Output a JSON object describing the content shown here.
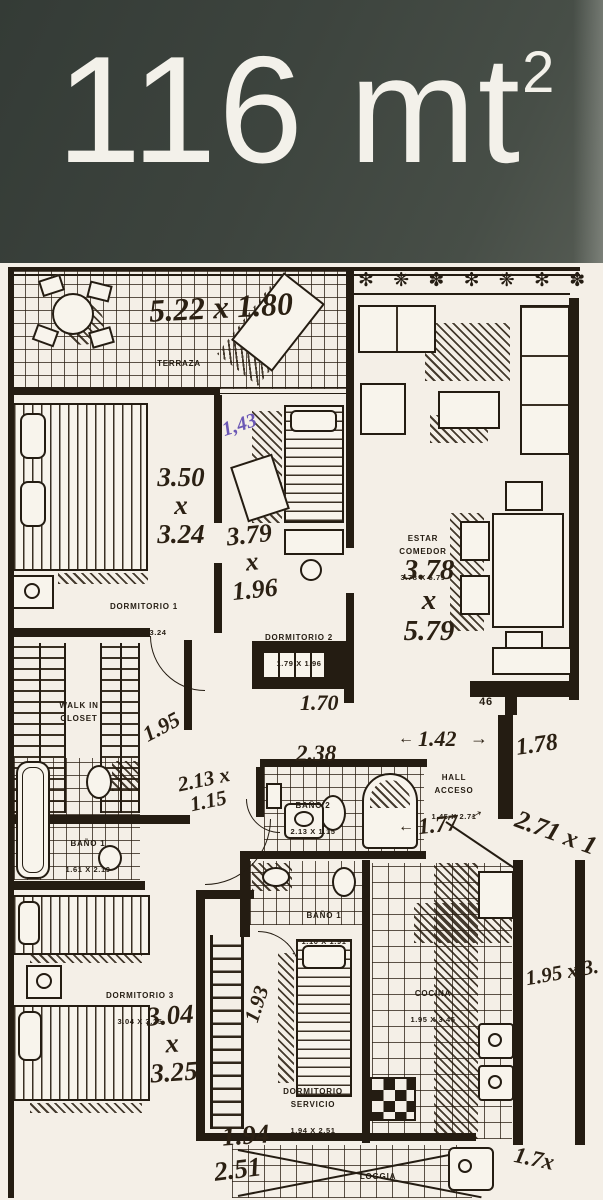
{
  "header": {
    "area_value": "116 mt",
    "area_exponent": "2"
  },
  "colors": {
    "header_bg": "#3d443e",
    "header_fg": "#f3f1ea",
    "paper": "#f4efe7",
    "ink": "#241c12",
    "purple_ink": "#6b57b5"
  },
  "rooms": {
    "terraza": {
      "name": "TERRAZA",
      "dims": "5.22 X 1.80"
    },
    "estar": {
      "name": "ESTAR\nCOMEDOR",
      "dims": "3.78 X 5.79"
    },
    "dormitorio1": {
      "name": "DORMITORIO 1",
      "dims": "3.50 X 3.24"
    },
    "dormitorio2": {
      "name": "DORMITORIO 2",
      "dims": "1.79 X 1.96"
    },
    "walkin": {
      "name": "WALK IN\nCLOSET"
    },
    "bano1_suite": {
      "name": "BAÑO 1",
      "dims": "1.61 X 2.19"
    },
    "bano2": {
      "name": "BAÑO 2",
      "dims": "2.13 X 1.15"
    },
    "hall": {
      "name": "HALL\nACCESO",
      "dims": "1.45 X 2.71"
    },
    "dormitorio3": {
      "name": "DORMITORIO 3",
      "dims": "3.04 X 3.25"
    },
    "bano1": {
      "name": "BAÑO 1",
      "dims": "1.10 X 1.91"
    },
    "dormservicio": {
      "name": "DORMITORIO\nSERVICIO",
      "dims": "1.94 X 2.51"
    },
    "cocina": {
      "name": "COCINA",
      "dims": "1.95 X 3.45"
    },
    "loggia": {
      "name": "LOGGIA",
      "dims": "3.00 X 1.95"
    }
  },
  "marks": {
    "num46": "46"
  },
  "icons": {
    "plants": "✻ ❋ ✽ ✻ ❋ ✻ ✽ ❋ ✻"
  },
  "handwritten": {
    "terraza": "5.22 x 1.80",
    "purple143": "1,43",
    "dorm1": "3.50\nx\n3.24",
    "dorm2": "3.79\nx\n1.96",
    "estar": "3.78\nx\n5.79",
    "closet195": "1.95",
    "bano2_dims": "2.13 x\n1.15",
    "bano2_238": "2.38",
    "hall142": "1.42",
    "arrow_right": "→",
    "arrow_left": "←",
    "wall178": "1.78",
    "hall177": "1.77",
    "diag271": "2.71 x 1",
    "right195x3": "1.95 x 3.",
    "dorm2_170": "1.70",
    "dorm3": "3.04\nx\n3.25",
    "vert193": "1.93",
    "serv194": "1.94",
    "serv251": "2.51",
    "corner17": "1.7x"
  }
}
